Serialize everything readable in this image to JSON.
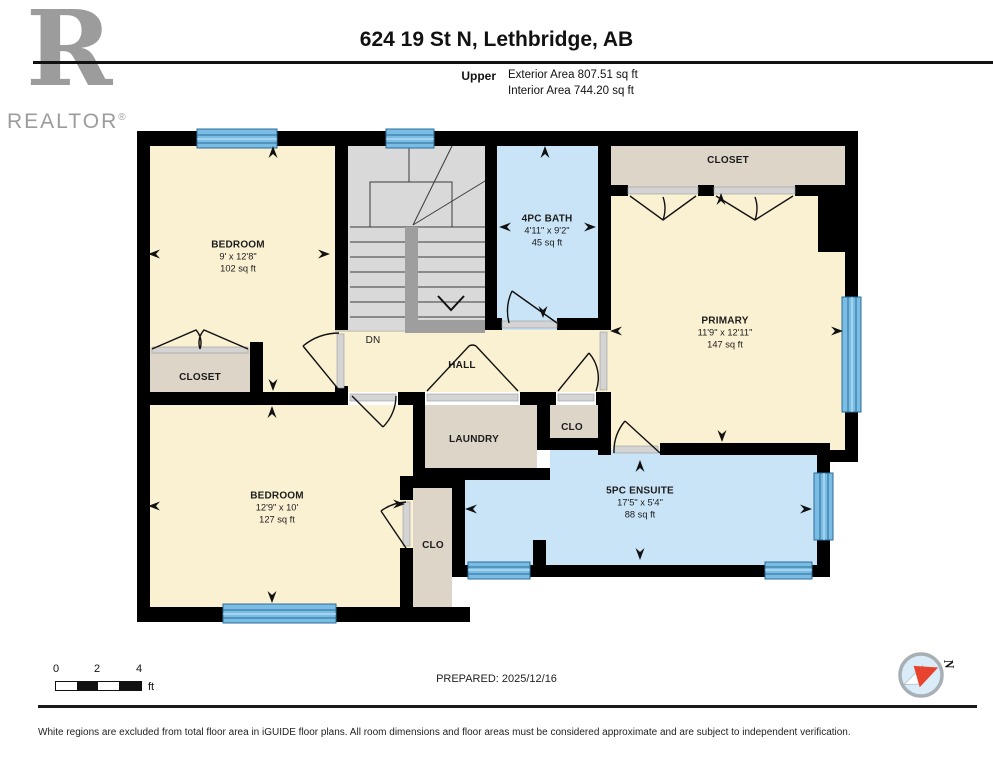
{
  "header": {
    "title": "624 19 St N, Lethbridge, AB",
    "floor_label": "Upper",
    "exterior_area": "Exterior Area 807.51 sq ft",
    "interior_area": "Interior Area 744.20 sq ft"
  },
  "brand": {
    "logo_letter": "R",
    "name": "REALTOR",
    "registered": "®"
  },
  "rooms": {
    "bedroom1": {
      "name": "BEDROOM",
      "dims": "9' x 12'8\"",
      "area": "102 sq ft"
    },
    "bath": {
      "name": "4PC BATH",
      "dims": "4'11\" x 9'2\"",
      "area": "45 sq ft"
    },
    "closet_primary": {
      "name": "CLOSET"
    },
    "primary": {
      "name": "PRIMARY",
      "dims": "11'9\" x 12'11\"",
      "area": "147 sq ft"
    },
    "stairs": {
      "name": "DN"
    },
    "hall": {
      "name": "HALL"
    },
    "closet1": {
      "name": "CLOSET"
    },
    "laundry": {
      "name": "LAUNDRY"
    },
    "clo_mid": {
      "name": "CLO"
    },
    "bedroom2": {
      "name": "BEDROOM",
      "dims": "12'9\" x 10'",
      "area": "127 sq ft"
    },
    "clo_bed": {
      "name": "CLO"
    },
    "ensuite": {
      "name": "5PC ENSUITE",
      "dims": "17'5\" x 5'4\"",
      "area": "88 sq ft"
    }
  },
  "footer": {
    "scale_ticks": [
      "0",
      "2",
      "4"
    ],
    "scale_unit": "ft",
    "prepared": "PREPARED: 2025/12/16",
    "compass_north": "N",
    "disclaimer": "White regions are excluded from total floor area in iGUIDE floor plans. All room dimensions and floor areas must be considered approximate and are subject to independent verification."
  },
  "colors": {
    "room_floor": "#FAF0D2",
    "wet_room": "#C9E4F7",
    "closet": "#DDD5C7",
    "stairs": "#D9D9D9",
    "window": "#79BCE4",
    "wall": "#000000"
  }
}
